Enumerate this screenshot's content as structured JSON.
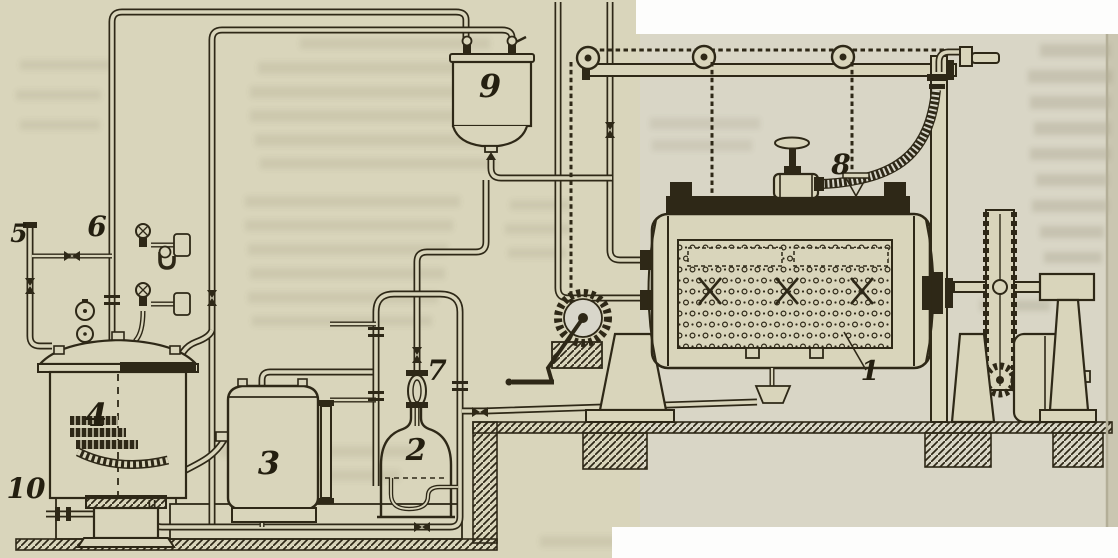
{
  "figure": {
    "kind": "scanned-engraving-technical-diagram",
    "subject": "industrial rotating perforated-drum machine installation with supply vessels, gauges, pump and piping",
    "paper_color": "#d9d5bb",
    "ink_color": "#2e2817",
    "labels": [
      {
        "name": "part-label-1",
        "text": "1"
      },
      {
        "name": "part-label-2",
        "text": "2"
      },
      {
        "name": "part-label-3",
        "text": "3"
      },
      {
        "name": "part-label-4",
        "text": "4"
      },
      {
        "name": "part-label-5",
        "text": "5"
      },
      {
        "name": "part-label-6",
        "text": "6"
      },
      {
        "name": "part-label-7",
        "text": "7"
      },
      {
        "name": "part-label-8",
        "text": "8"
      },
      {
        "name": "part-label-9",
        "text": "9"
      },
      {
        "name": "part-label-10",
        "text": "10"
      }
    ]
  }
}
